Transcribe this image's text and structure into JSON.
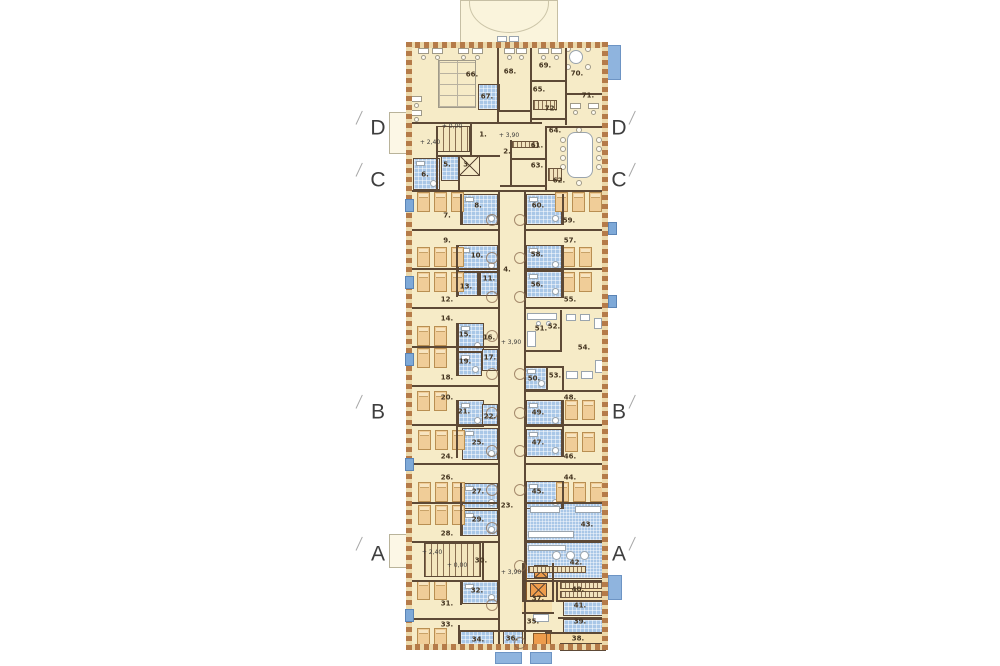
{
  "title": "hospital-ward-floor-plan",
  "colors": {
    "background": "#ffffff",
    "floor": "#f6ebc7",
    "wall": "#5d4936",
    "exterior_hatch": "#b57b49",
    "bathroom": "#a9c7e7",
    "bed": "#f0cd98",
    "window": "#7ea9d8",
    "balcony": "#8fb4de",
    "shaft": "#ed9c4c",
    "label": "#43331f"
  },
  "section_markers": [
    {
      "label": "D",
      "left": {
        "x": 378,
        "y": 128
      },
      "right": {
        "x": 619,
        "y": 128
      }
    },
    {
      "label": "C",
      "left": {
        "x": 378,
        "y": 180
      },
      "right": {
        "x": 619,
        "y": 180
      }
    },
    {
      "label": "B",
      "left": {
        "x": 378,
        "y": 412
      },
      "right": {
        "x": 619,
        "y": 412
      }
    },
    {
      "label": "A",
      "left": {
        "x": 378,
        "y": 554
      },
      "right": {
        "x": 619,
        "y": 554
      }
    }
  ],
  "level_labels": [
    {
      "text": "+ 0,00",
      "x": 452,
      "y": 127
    },
    {
      "text": "+ 2,40",
      "x": 430,
      "y": 143
    },
    {
      "text": "+ 3,90",
      "x": 509,
      "y": 136
    },
    {
      "text": "+ 3,90",
      "x": 511,
      "y": 343
    },
    {
      "text": "+ 2,40",
      "x": 432,
      "y": 553
    },
    {
      "text": "+ 0,00",
      "x": 457,
      "y": 566
    },
    {
      "text": "+ 3,90",
      "x": 511,
      "y": 573
    }
  ],
  "room_labels": [
    {
      "n": "1.",
      "x": 483,
      "y": 135
    },
    {
      "n": "2.",
      "x": 507,
      "y": 152
    },
    {
      "n": "3.",
      "x": 467,
      "y": 165
    },
    {
      "n": "4.",
      "x": 507,
      "y": 270
    },
    {
      "n": "5.",
      "x": 447,
      "y": 165
    },
    {
      "n": "6.",
      "x": 425,
      "y": 175
    },
    {
      "n": "7.",
      "x": 447,
      "y": 216
    },
    {
      "n": "8.",
      "x": 478,
      "y": 206
    },
    {
      "n": "9.",
      "x": 447,
      "y": 241
    },
    {
      "n": "10.",
      "x": 477,
      "y": 256
    },
    {
      "n": "11.",
      "x": 489,
      "y": 279
    },
    {
      "n": "12.",
      "x": 447,
      "y": 300
    },
    {
      "n": "13.",
      "x": 466,
      "y": 287
    },
    {
      "n": "14.",
      "x": 447,
      "y": 319
    },
    {
      "n": "15.",
      "x": 465,
      "y": 335
    },
    {
      "n": "16.",
      "x": 489,
      "y": 338
    },
    {
      "n": "17.",
      "x": 490,
      "y": 358
    },
    {
      "n": "18.",
      "x": 447,
      "y": 378
    },
    {
      "n": "19.",
      "x": 465,
      "y": 362
    },
    {
      "n": "20.",
      "x": 447,
      "y": 398
    },
    {
      "n": "21.",
      "x": 464,
      "y": 412
    },
    {
      "n": "22.",
      "x": 490,
      "y": 417
    },
    {
      "n": "23.",
      "x": 507,
      "y": 506
    },
    {
      "n": "24.",
      "x": 447,
      "y": 457
    },
    {
      "n": "25.",
      "x": 478,
      "y": 443
    },
    {
      "n": "26.",
      "x": 447,
      "y": 478
    },
    {
      "n": "27.",
      "x": 478,
      "y": 492
    },
    {
      "n": "28.",
      "x": 447,
      "y": 534
    },
    {
      "n": "29.",
      "x": 478,
      "y": 520
    },
    {
      "n": "30.",
      "x": 481,
      "y": 561
    },
    {
      "n": "31.",
      "x": 447,
      "y": 604
    },
    {
      "n": "32.",
      "x": 477,
      "y": 591
    },
    {
      "n": "33.",
      "x": 447,
      "y": 625
    },
    {
      "n": "34.",
      "x": 478,
      "y": 640
    },
    {
      "n": "35.",
      "x": 533,
      "y": 622
    },
    {
      "n": "36.",
      "x": 512,
      "y": 639
    },
    {
      "n": "37.",
      "x": 538,
      "y": 599
    },
    {
      "n": "38.",
      "x": 578,
      "y": 639
    },
    {
      "n": "39.",
      "x": 580,
      "y": 622
    },
    {
      "n": "40.",
      "x": 578,
      "y": 590
    },
    {
      "n": "41.",
      "x": 580,
      "y": 606
    },
    {
      "n": "42.",
      "x": 576,
      "y": 563
    },
    {
      "n": "43.",
      "x": 587,
      "y": 525
    },
    {
      "n": "44.",
      "x": 570,
      "y": 478
    },
    {
      "n": "45.",
      "x": 538,
      "y": 492
    },
    {
      "n": "46.",
      "x": 570,
      "y": 457
    },
    {
      "n": "47.",
      "x": 538,
      "y": 443
    },
    {
      "n": "48.",
      "x": 570,
      "y": 398
    },
    {
      "n": "49.",
      "x": 538,
      "y": 413
    },
    {
      "n": "50.",
      "x": 534,
      "y": 379
    },
    {
      "n": "51.",
      "x": 541,
      "y": 329
    },
    {
      "n": "52.",
      "x": 554,
      "y": 327
    },
    {
      "n": "53.",
      "x": 555,
      "y": 376
    },
    {
      "n": "54.",
      "x": 584,
      "y": 348
    },
    {
      "n": "55.",
      "x": 570,
      "y": 300
    },
    {
      "n": "56.",
      "x": 537,
      "y": 285
    },
    {
      "n": "57.",
      "x": 570,
      "y": 241
    },
    {
      "n": "58.",
      "x": 537,
      "y": 255
    },
    {
      "n": "59.",
      "x": 569,
      "y": 221
    },
    {
      "n": "60.",
      "x": 538,
      "y": 206
    },
    {
      "n": "61.",
      "x": 537,
      "y": 146
    },
    {
      "n": "62.",
      "x": 559,
      "y": 181
    },
    {
      "n": "63.",
      "x": 537,
      "y": 166
    },
    {
      "n": "64.",
      "x": 555,
      "y": 131
    },
    {
      "n": "65.",
      "x": 539,
      "y": 90
    },
    {
      "n": "66.",
      "x": 472,
      "y": 75
    },
    {
      "n": "67.",
      "x": 487,
      "y": 97
    },
    {
      "n": "68.",
      "x": 510,
      "y": 72
    },
    {
      "n": "69.",
      "x": 545,
      "y": 66
    },
    {
      "n": "70.",
      "x": 577,
      "y": 74
    },
    {
      "n": "71.",
      "x": 588,
      "y": 96
    },
    {
      "n": "72.",
      "x": 551,
      "y": 109
    }
  ],
  "plan": {
    "building": [
      406,
      42,
      202,
      608
    ],
    "canopy": [
      460,
      0,
      98,
      43
    ],
    "canopy_doors": [
      [
        497,
        36,
        10,
        6
      ],
      [
        509,
        36,
        10,
        6
      ]
    ],
    "hatch_edges": {
      "top": [
        406,
        42,
        202,
        6
      ],
      "bottom": [
        406,
        644,
        202,
        6
      ],
      "left": [
        406,
        42,
        6,
        608
      ],
      "right": [
        602,
        42,
        6,
        608
      ]
    },
    "walls_h": [
      [
        406,
        122,
        136
      ],
      [
        545,
        126,
        63
      ],
      [
        497,
        110,
        33
      ],
      [
        530,
        80,
        35
      ],
      [
        565,
        93,
        43
      ],
      [
        530,
        118,
        35
      ],
      [
        510,
        158,
        35
      ],
      [
        500,
        185,
        46
      ],
      [
        436,
        155,
        64
      ],
      [
        406,
        190,
        202
      ],
      [
        406,
        229,
        94
      ],
      [
        406,
        268,
        94
      ],
      [
        406,
        307,
        94
      ],
      [
        406,
        346,
        94
      ],
      [
        406,
        385,
        94
      ],
      [
        406,
        424,
        94
      ],
      [
        406,
        463,
        94
      ],
      [
        406,
        502,
        94
      ],
      [
        406,
        541,
        94
      ],
      [
        406,
        580,
        94
      ],
      [
        406,
        618,
        94
      ],
      [
        526,
        229,
        82
      ],
      [
        526,
        268,
        82
      ],
      [
        526,
        307,
        82
      ],
      [
        524,
        350,
        38
      ],
      [
        524,
        366,
        38
      ],
      [
        526,
        390,
        82
      ],
      [
        526,
        424,
        82
      ],
      [
        526,
        463,
        82
      ],
      [
        526,
        502,
        82
      ],
      [
        526,
        541,
        82
      ],
      [
        526,
        580,
        82
      ],
      [
        558,
        600,
        50
      ],
      [
        558,
        617,
        50
      ],
      [
        545,
        632,
        63
      ],
      [
        522,
        600,
        32
      ],
      [
        522,
        612,
        32
      ],
      [
        460,
        630,
        92
      ]
    ],
    "walls_v": [
      [
        497,
        45,
        77
      ],
      [
        530,
        45,
        77
      ],
      [
        565,
        45,
        80
      ],
      [
        436,
        126,
        64
      ],
      [
        470,
        122,
        33
      ],
      [
        458,
        155,
        35
      ],
      [
        510,
        140,
        45
      ],
      [
        545,
        126,
        64
      ],
      [
        560,
        310,
        40
      ],
      [
        546,
        366,
        24
      ],
      [
        562,
        366,
        24
      ],
      [
        498,
        190,
        458
      ],
      [
        524,
        190,
        458
      ],
      [
        460,
        194,
        31
      ],
      [
        456,
        245,
        52
      ],
      [
        478,
        272,
        24
      ],
      [
        456,
        323,
        53
      ],
      [
        456,
        400,
        58
      ],
      [
        460,
        483,
        53
      ],
      [
        460,
        581,
        24
      ],
      [
        458,
        625,
        25
      ],
      [
        562,
        194,
        31
      ],
      [
        562,
        245,
        53
      ],
      [
        562,
        400,
        57
      ],
      [
        562,
        481,
        28
      ],
      [
        522,
        563,
        37
      ],
      [
        552,
        563,
        37
      ],
      [
        482,
        541,
        39
      ],
      [
        556,
        580,
        22
      ]
    ],
    "baths": [
      [
        478,
        84,
        22,
        26
      ],
      [
        413,
        158,
        27,
        32
      ],
      [
        441,
        155,
        18,
        26
      ],
      [
        462,
        194,
        36,
        31
      ],
      [
        526,
        194,
        36,
        31
      ],
      [
        458,
        245,
        40,
        27
      ],
      [
        480,
        272,
        18,
        24
      ],
      [
        458,
        272,
        20,
        24
      ],
      [
        526,
        245,
        36,
        26
      ],
      [
        526,
        271,
        36,
        27
      ],
      [
        458,
        323,
        26,
        29
      ],
      [
        482,
        349,
        16,
        22
      ],
      [
        458,
        352,
        24,
        24
      ],
      [
        458,
        400,
        26,
        27
      ],
      [
        482,
        404,
        16,
        22
      ],
      [
        462,
        428,
        36,
        32
      ],
      [
        526,
        400,
        36,
        27
      ],
      [
        526,
        429,
        36,
        28
      ],
      [
        462,
        483,
        36,
        26
      ],
      [
        462,
        510,
        36,
        26
      ],
      [
        526,
        481,
        36,
        28
      ],
      [
        524,
        366,
        24,
        24
      ],
      [
        462,
        581,
        36,
        23
      ],
      [
        460,
        630,
        34,
        19
      ],
      [
        503,
        631,
        20,
        18
      ],
      [
        563,
        601,
        43,
        15
      ],
      [
        563,
        619,
        43,
        15
      ]
    ],
    "kitchens": [
      [
        526,
        503,
        78,
        38
      ],
      [
        526,
        542,
        78,
        37
      ],
      [
        560,
        643,
        46,
        8
      ]
    ],
    "beds": [
      [
        417,
        192,
        3
      ],
      [
        417,
        247,
        3
      ],
      [
        417,
        272,
        3
      ],
      [
        417,
        326,
        2
      ],
      [
        417,
        348,
        2
      ],
      [
        417,
        391,
        2
      ],
      [
        418,
        430,
        3
      ],
      [
        418,
        482,
        3
      ],
      [
        418,
        505,
        3
      ],
      [
        417,
        580,
        2
      ],
      [
        417,
        628,
        2
      ],
      [
        555,
        192,
        3
      ],
      [
        562,
        247,
        2
      ],
      [
        562,
        272,
        2
      ],
      [
        565,
        400,
        2
      ],
      [
        565,
        432,
        2
      ],
      [
        556,
        482,
        3
      ]
    ],
    "stairs": [
      [
        436,
        126,
        34,
        26
      ],
      [
        424,
        543,
        57,
        34
      ]
    ],
    "lifts": [
      [
        459,
        155,
        21,
        21
      ]
    ],
    "shafts": [
      [
        534,
        565,
        14,
        13
      ],
      [
        530,
        583,
        17,
        14
      ]
    ],
    "orange_strips": [
      [
        522,
        565,
        5,
        35
      ],
      [
        545,
        633,
        6,
        16
      ],
      [
        533,
        633,
        14,
        14
      ]
    ],
    "tints": [
      [
        552,
        580,
        54,
        21
      ],
      [
        545,
        632,
        60,
        14
      ],
      [
        523,
        563,
        29,
        37
      ],
      [
        522,
        600,
        30,
        12
      ]
    ],
    "windows_left": [
      199,
      276,
      353,
      458,
      609
    ],
    "windows_right": [
      222,
      295
    ],
    "balconies": [
      [
        607,
        45,
        14,
        35
      ],
      [
        608,
        575,
        14,
        25
      ],
      [
        495,
        652,
        27,
        12
      ],
      [
        530,
        652,
        22,
        12
      ]
    ],
    "terraces": [
      [
        389,
        112,
        18,
        42
      ],
      [
        389,
        534,
        18,
        34
      ]
    ],
    "cluster66": [
      438,
      60,
      38,
      48
    ],
    "table64": [
      567,
      132,
      26,
      46
    ],
    "chairs64": [
      [
        560,
        137
      ],
      [
        560,
        146
      ],
      [
        560,
        155
      ],
      [
        560,
        164
      ],
      [
        596,
        137
      ],
      [
        596,
        146
      ],
      [
        596,
        155
      ],
      [
        596,
        164
      ],
      [
        576,
        127
      ],
      [
        576,
        180
      ]
    ],
    "round70": [
      569,
      50,
      14
    ],
    "chairs70": [
      [
        565,
        46
      ],
      [
        585,
        46
      ],
      [
        565,
        64
      ],
      [
        585,
        64
      ]
    ],
    "desks": [
      [
        418,
        48
      ],
      [
        432,
        48
      ],
      [
        458,
        48
      ],
      [
        472,
        48
      ],
      [
        504,
        48
      ],
      [
        516,
        48
      ],
      [
        538,
        48
      ],
      [
        551,
        48
      ],
      [
        588,
        103
      ],
      [
        570,
        103
      ],
      [
        411,
        96
      ],
      [
        411,
        110
      ]
    ],
    "white_rects": [
      [
        566,
        314,
        10,
        7
      ],
      [
        580,
        314,
        10,
        7
      ],
      [
        594,
        318,
        8,
        11
      ],
      [
        566,
        371,
        12,
        8
      ],
      [
        581,
        371,
        12,
        8
      ],
      [
        595,
        360,
        8,
        13
      ],
      [
        527,
        313,
        30,
        7
      ],
      [
        527,
        331,
        9,
        16
      ],
      [
        530,
        506,
        30,
        7
      ],
      [
        575,
        506,
        26,
        7
      ],
      [
        528,
        531,
        46,
        7
      ],
      [
        528,
        545,
        38,
        6
      ],
      [
        533,
        614,
        16,
        8
      ]
    ],
    "white_circles": [
      [
        536,
        321,
        5
      ],
      [
        546,
        321,
        5
      ],
      [
        552,
        551,
        9
      ],
      [
        566,
        551,
        9
      ],
      [
        580,
        551,
        9
      ]
    ],
    "hatch_boxes": [
      [
        512,
        141,
        26,
        7
      ],
      [
        548,
        168,
        14,
        13
      ],
      [
        533,
        100,
        24,
        10
      ],
      [
        560,
        582,
        44,
        7
      ],
      [
        560,
        591,
        44,
        7
      ],
      [
        528,
        566,
        58,
        7
      ]
    ],
    "arcs_left": [
      214,
      252,
      291,
      330,
      368,
      407,
      445,
      484,
      522,
      599
    ],
    "arcs_right": [
      214,
      252,
      291,
      368,
      407,
      445,
      484,
      560,
      637
    ]
  }
}
